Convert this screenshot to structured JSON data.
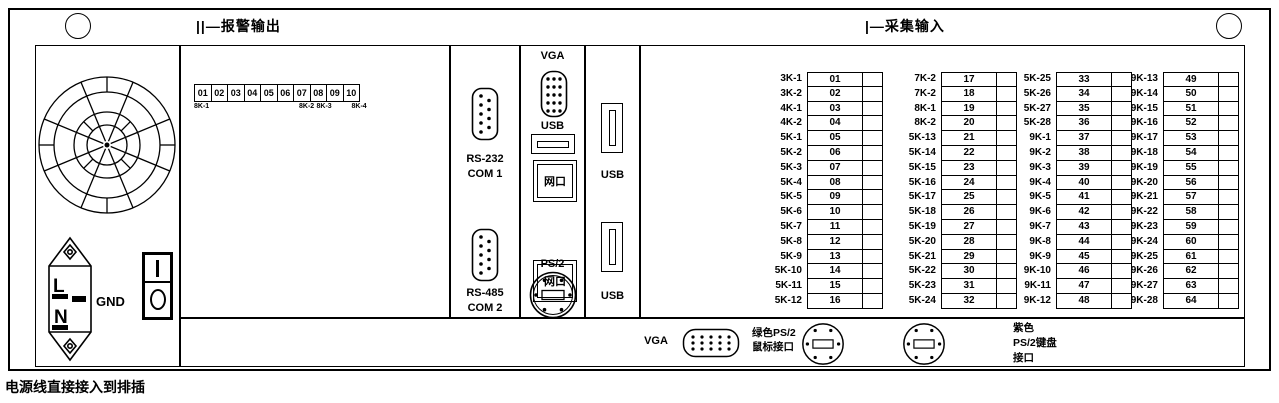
{
  "titles": {
    "alarm_output": "||—报警输出",
    "acquisition_input": "|—采集输入"
  },
  "note": "电源线直接接入到排插",
  "power": {
    "gnd": "GND",
    "line": "L",
    "neutral": "N"
  },
  "com": {
    "rs232": "RS-232",
    "com1": "COM 1",
    "rs485": "RS-485",
    "com2": "COM 2"
  },
  "io": {
    "vga": "VGA",
    "usb": "USB",
    "lan": "网口",
    "ps2": "PS/2"
  },
  "usb_panel": {
    "usb": "USB"
  },
  "bottom": {
    "vga": "VGA",
    "green_ps2": "绿色PS/2\n鼠标接口",
    "purple_ps2": "紫色\nPS/2键盘\n接口"
  },
  "alarm_strip": {
    "numbers": [
      "01",
      "02",
      "03",
      "04",
      "05",
      "06",
      "07",
      "08",
      "09",
      "10"
    ],
    "sublabels": [
      {
        "text": "8K-1",
        "cell": 1
      },
      {
        "text": "8K-2",
        "cell": 7
      },
      {
        "text": "8K-3",
        "cell": 8
      },
      {
        "text": "8K-4",
        "cell": 10
      }
    ]
  },
  "acquisition": {
    "columns": [
      {
        "labels": [
          "3K-1",
          "3K-2",
          "4K-1",
          "4K-2",
          "5K-1",
          "5K-2",
          "5K-3",
          "5K-4",
          "5K-5",
          "5K-6",
          "5K-7",
          "5K-8",
          "5K-9",
          "5K-10",
          "5K-11",
          "5K-12"
        ],
        "numbers": [
          "01",
          "02",
          "03",
          "04",
          "05",
          "06",
          "07",
          "08",
          "09",
          "10",
          "11",
          "12",
          "13",
          "14",
          "15",
          "16"
        ]
      },
      {
        "labels": [
          "7K-2",
          "7K-2",
          "8K-1",
          "8K-2",
          "5K-13",
          "5K-14",
          "5K-15",
          "5K-16",
          "5K-17",
          "5K-18",
          "5K-19",
          "5K-20",
          "5K-21",
          "5K-22",
          "5K-23",
          "5K-24"
        ],
        "numbers": [
          "17",
          "18",
          "19",
          "20",
          "21",
          "22",
          "23",
          "24",
          "25",
          "26",
          "27",
          "28",
          "29",
          "30",
          "31",
          "32"
        ]
      },
      {
        "labels": [
          "5K-25",
          "5K-26",
          "5K-27",
          "5K-28",
          "9K-1",
          "9K-2",
          "9K-3",
          "9K-4",
          "9K-5",
          "9K-6",
          "9K-7",
          "9K-8",
          "9K-9",
          "9K-10",
          "9K-11",
          "9K-12"
        ],
        "numbers": [
          "33",
          "34",
          "35",
          "36",
          "37",
          "38",
          "39",
          "40",
          "41",
          "42",
          "43",
          "44",
          "45",
          "46",
          "47",
          "48"
        ]
      },
      {
        "labels": [
          "9K-13",
          "9K-14",
          "9K-15",
          "9K-16",
          "9K-17",
          "9K-18",
          "9K-19",
          "9K-20",
          "9K-21",
          "9K-22",
          "9K-23",
          "9K-24",
          "9K-25",
          "9K-26",
          "9K-27",
          "9K-28"
        ],
        "numbers": [
          "49",
          "50",
          "51",
          "52",
          "53",
          "54",
          "55",
          "56",
          "57",
          "58",
          "59",
          "60",
          "61",
          "62",
          "63",
          "64"
        ]
      }
    ]
  }
}
